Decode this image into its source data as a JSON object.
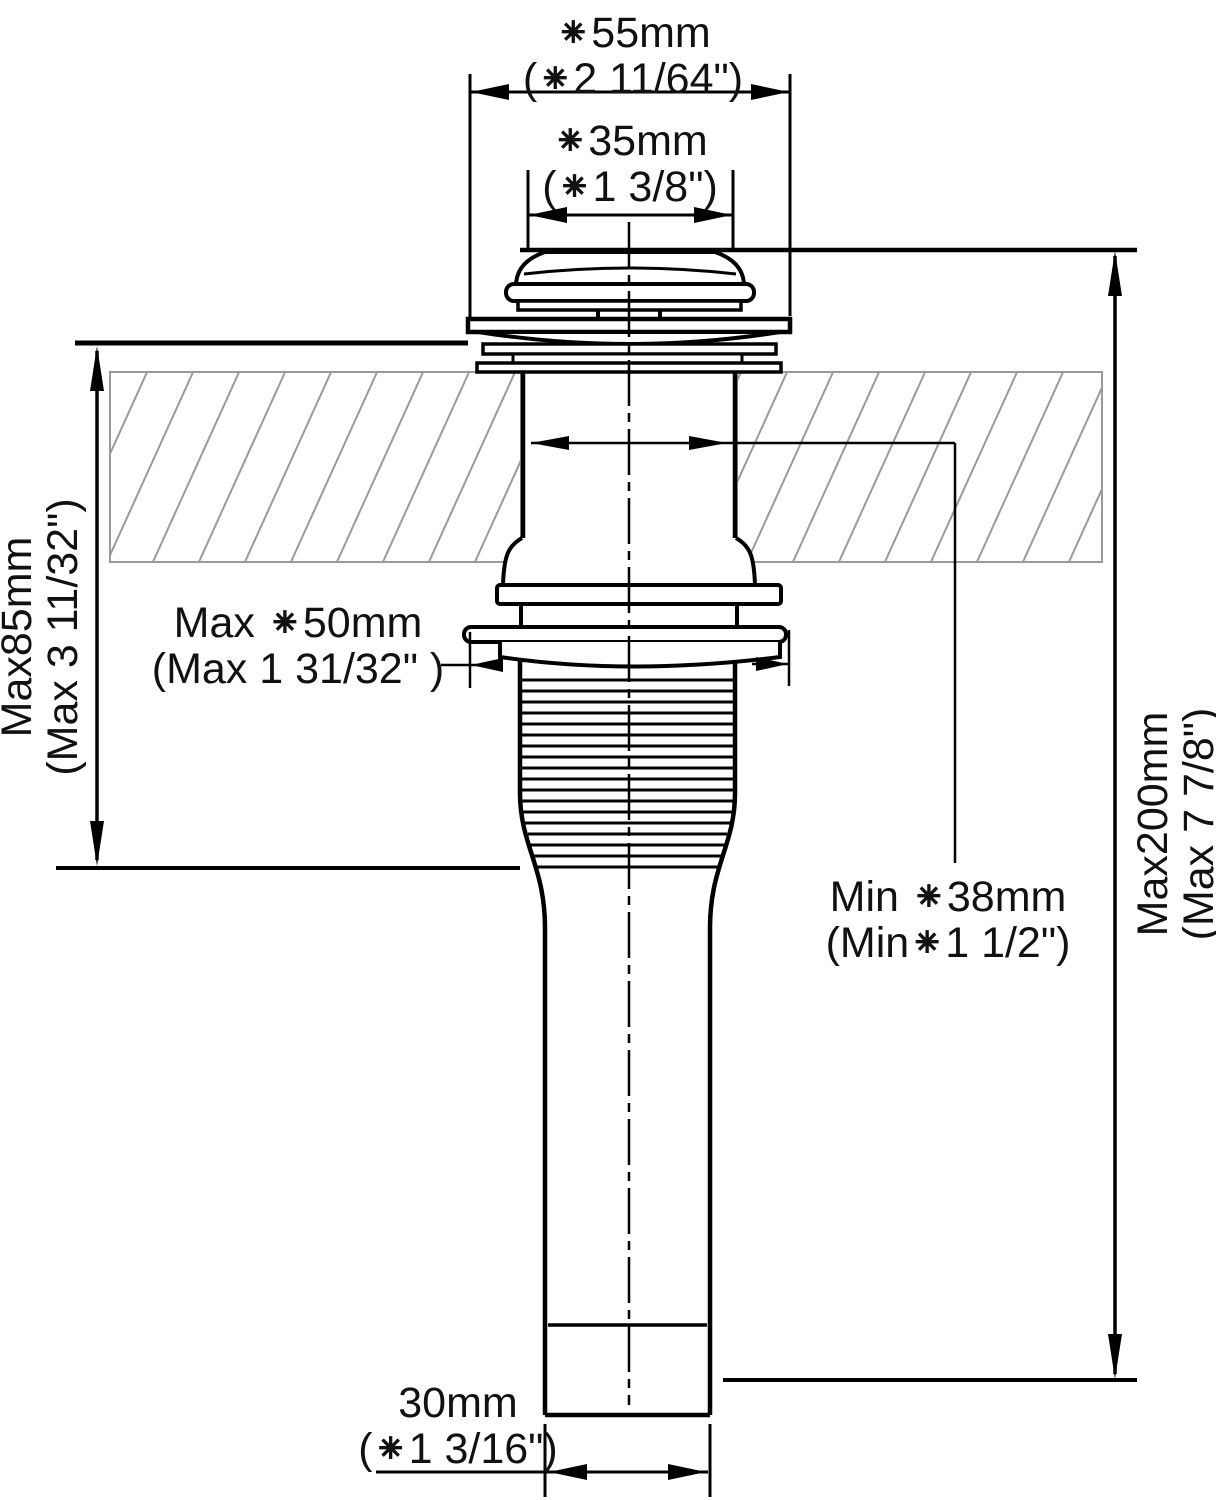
{
  "diagram": {
    "type": "technical-drawing",
    "subject": "pop-up sink drain mounting dimensions",
    "colors": {
      "line": "#000000",
      "hatch": "#9a9a9a",
      "background": "#ffffff",
      "text": "#111111"
    }
  },
  "labels": {
    "top_outer_diameter": {
      "line1": "⁕55mm",
      "line2": "(⁕2 11/64\")"
    },
    "top_inner_diameter": {
      "line1": "⁕35mm",
      "line2": "(⁕1 3/8\")"
    },
    "max_deck_thickness": {
      "line1": "Max85mm",
      "line2": "(Max 3 11/32\")"
    },
    "max_locknut_diameter": {
      "line1": "Max ⁕50mm",
      "line2": "(Max 1 31/32\" )"
    },
    "min_hole_diameter": {
      "line1": "Min ⁕38mm",
      "line2": "(Min⁕1 1/2\")"
    },
    "max_overall_length": {
      "line1": "Max200mm",
      "line2": "(Max 7 7/8\")"
    },
    "tailpipe_diameter": {
      "line1": "30mm",
      "line2": "(⁕1 3/16\")"
    }
  }
}
